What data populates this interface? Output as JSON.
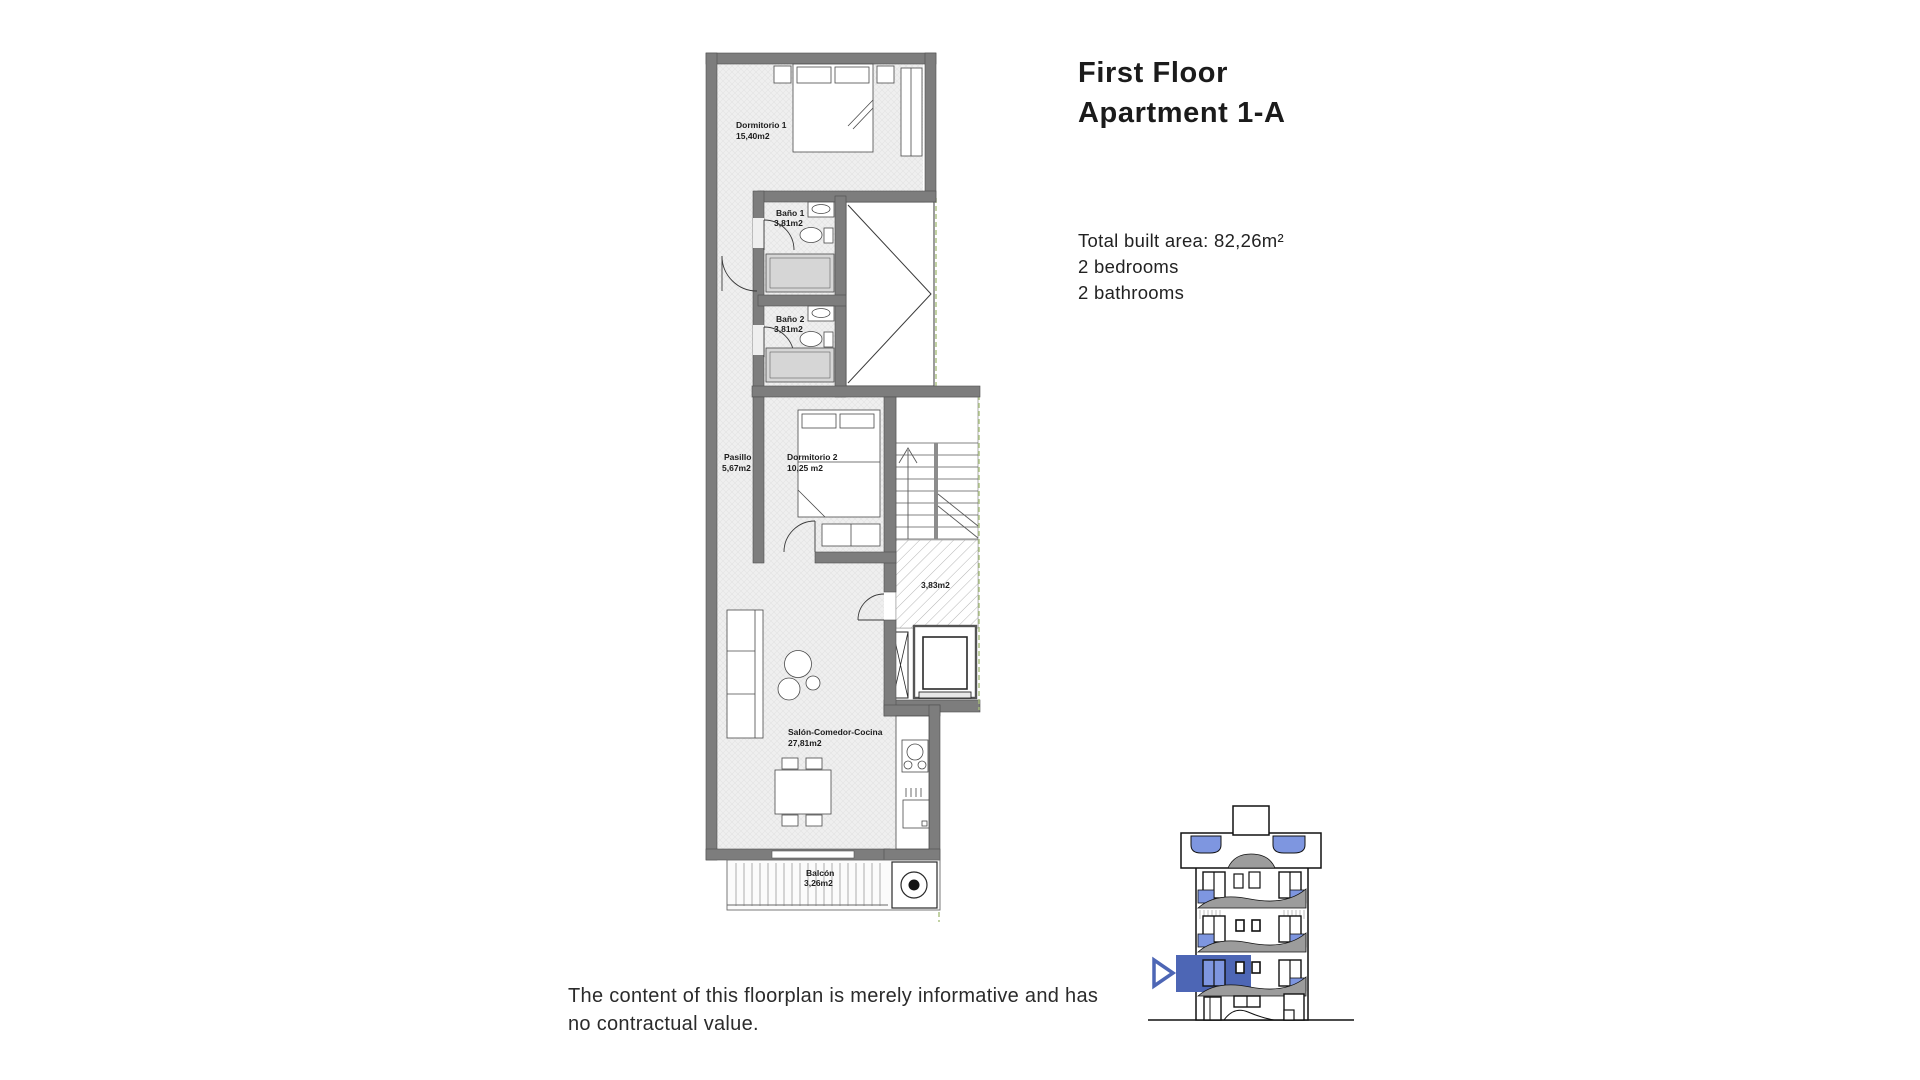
{
  "header": {
    "title_line1": "First Floor",
    "title_line2": "Apartment 1-A"
  },
  "summary": {
    "total_area": "Total built area: 82,26m²",
    "bedrooms": "2 bedrooms",
    "bathrooms": "2 bathrooms"
  },
  "footer": {
    "disclaimer": "The content of this floorplan is merely informative and has no contractual value."
  },
  "floorplan": {
    "rooms": [
      {
        "id": "dormitorio1",
        "name": "Dormitorio 1",
        "area": "15,40m2"
      },
      {
        "id": "bano1",
        "name": "Baño 1",
        "area": "3,81m2"
      },
      {
        "id": "bano2",
        "name": "Baño 2",
        "area": "3,81m2"
      },
      {
        "id": "pasillo",
        "name": "Pasillo",
        "area": "5,67m2"
      },
      {
        "id": "dormitorio2",
        "name": "Dormitorio 2",
        "area": "10,25 m2"
      },
      {
        "id": "landing",
        "name": "",
        "area": "3,83m2"
      },
      {
        "id": "salon",
        "name": "Salón-Comedor-Cocina",
        "area": "27,81m2"
      },
      {
        "id": "balcon",
        "name": "Balcón",
        "area": "3,26m2"
      }
    ]
  },
  "elevation": {
    "icon": "location-arrow-icon",
    "highlighted_floor": "first floor"
  },
  "colors": {
    "wall_gray": "#7d7d7d",
    "floor_fill": "#efefef",
    "accent_blue": "#4d66b5",
    "glass_blue": "#7e96e0",
    "parapet_gray": "#9c9c9c",
    "boundary_green": "#a8bf7d"
  }
}
